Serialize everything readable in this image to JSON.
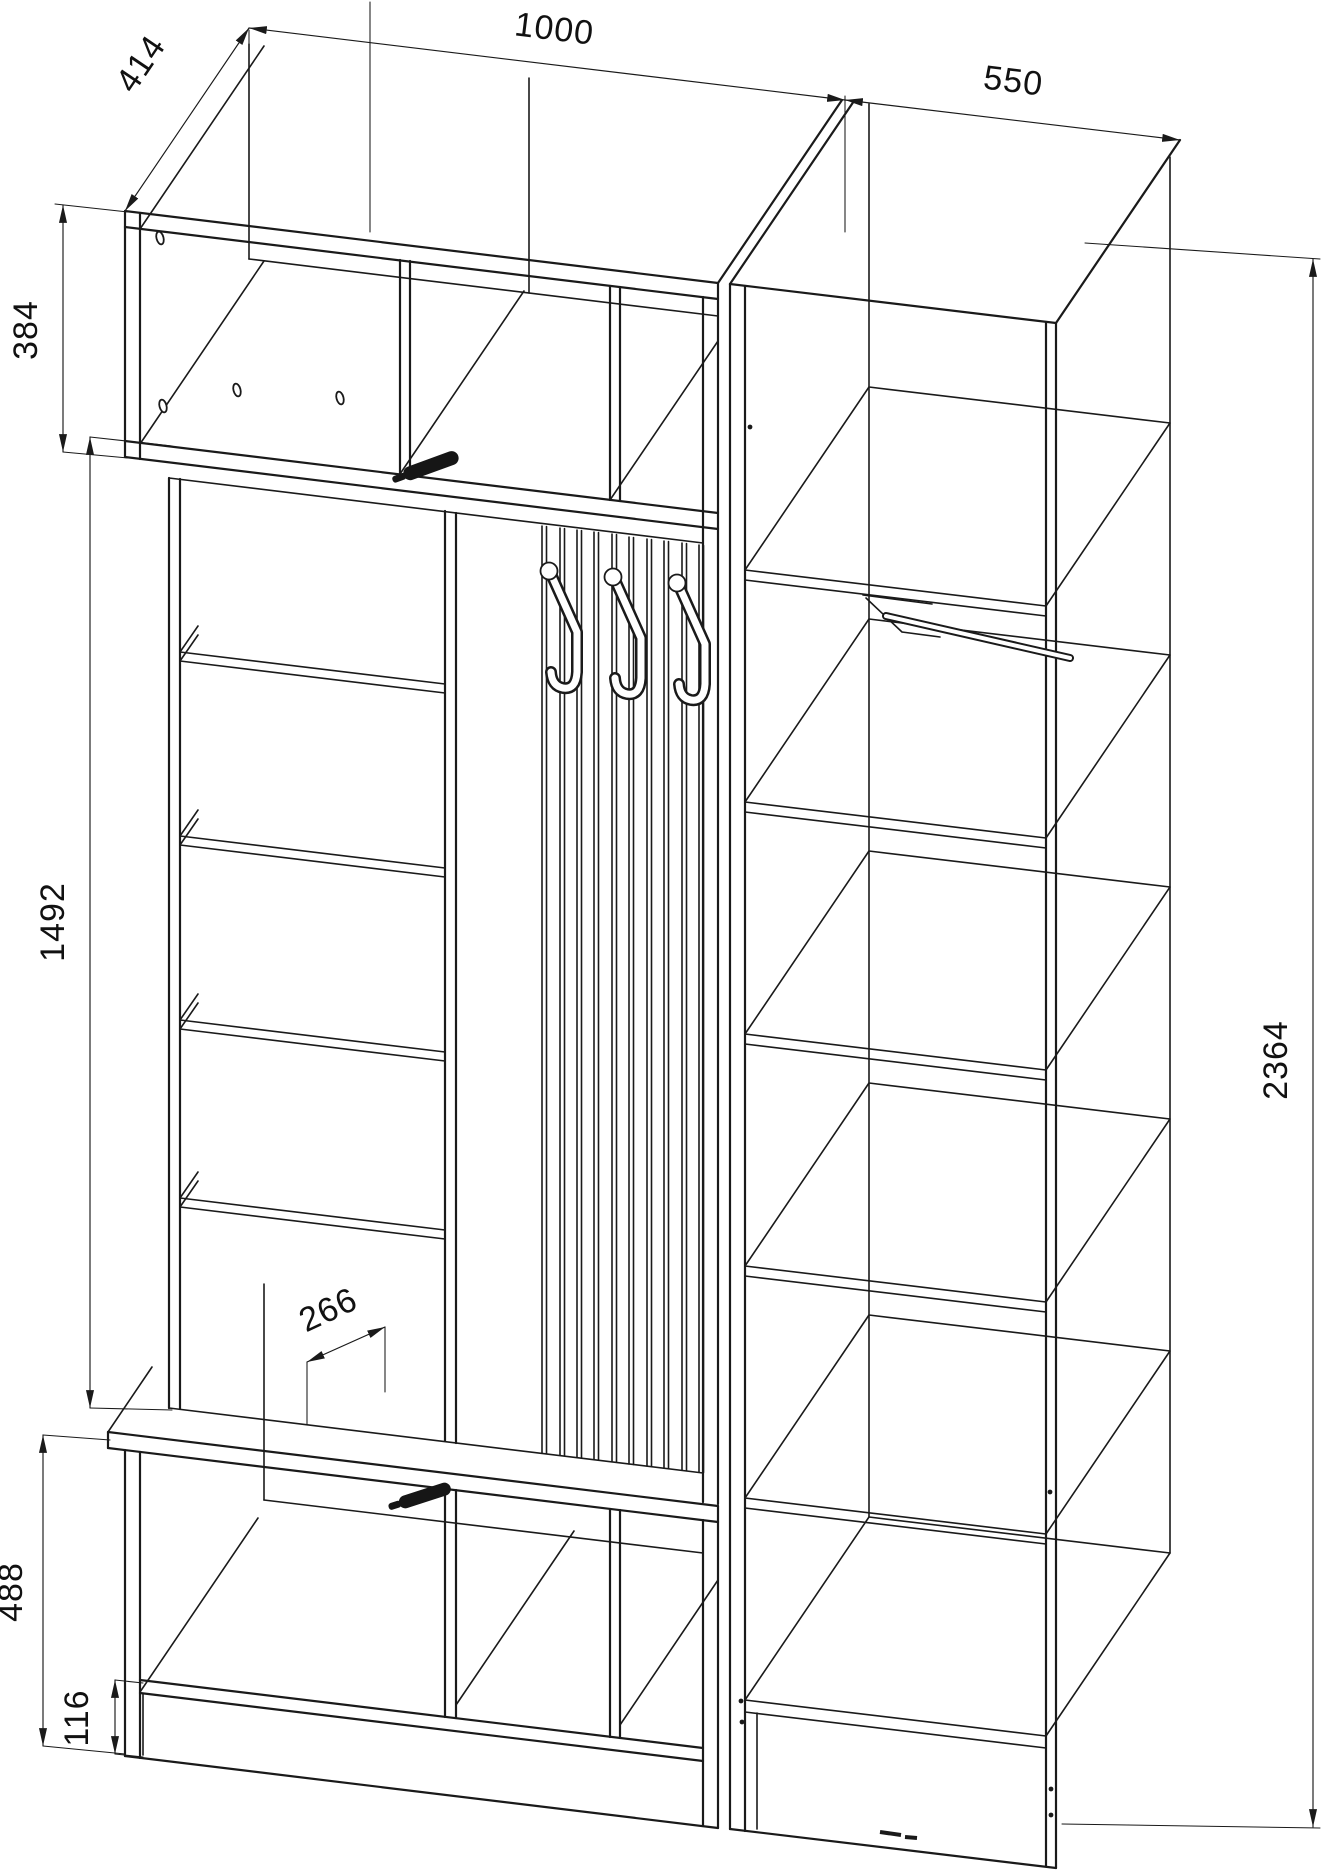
{
  "colors": {
    "background": "#ffffff",
    "line": "#1a1a1a",
    "dimension_text": "#111111",
    "handle_fill": "#161616"
  },
  "drawing": {
    "type": "furniture-assembly-isometric-view",
    "dimensions": {
      "top_depth": "414",
      "left_width": "1000",
      "right_width": "550",
      "upper_cabinet_height": "384",
      "middle_height": "1492",
      "total_height": "2364",
      "lower_shelf_depth": "266",
      "lower_cabinet_height": "488",
      "plinth_height": "116"
    }
  }
}
